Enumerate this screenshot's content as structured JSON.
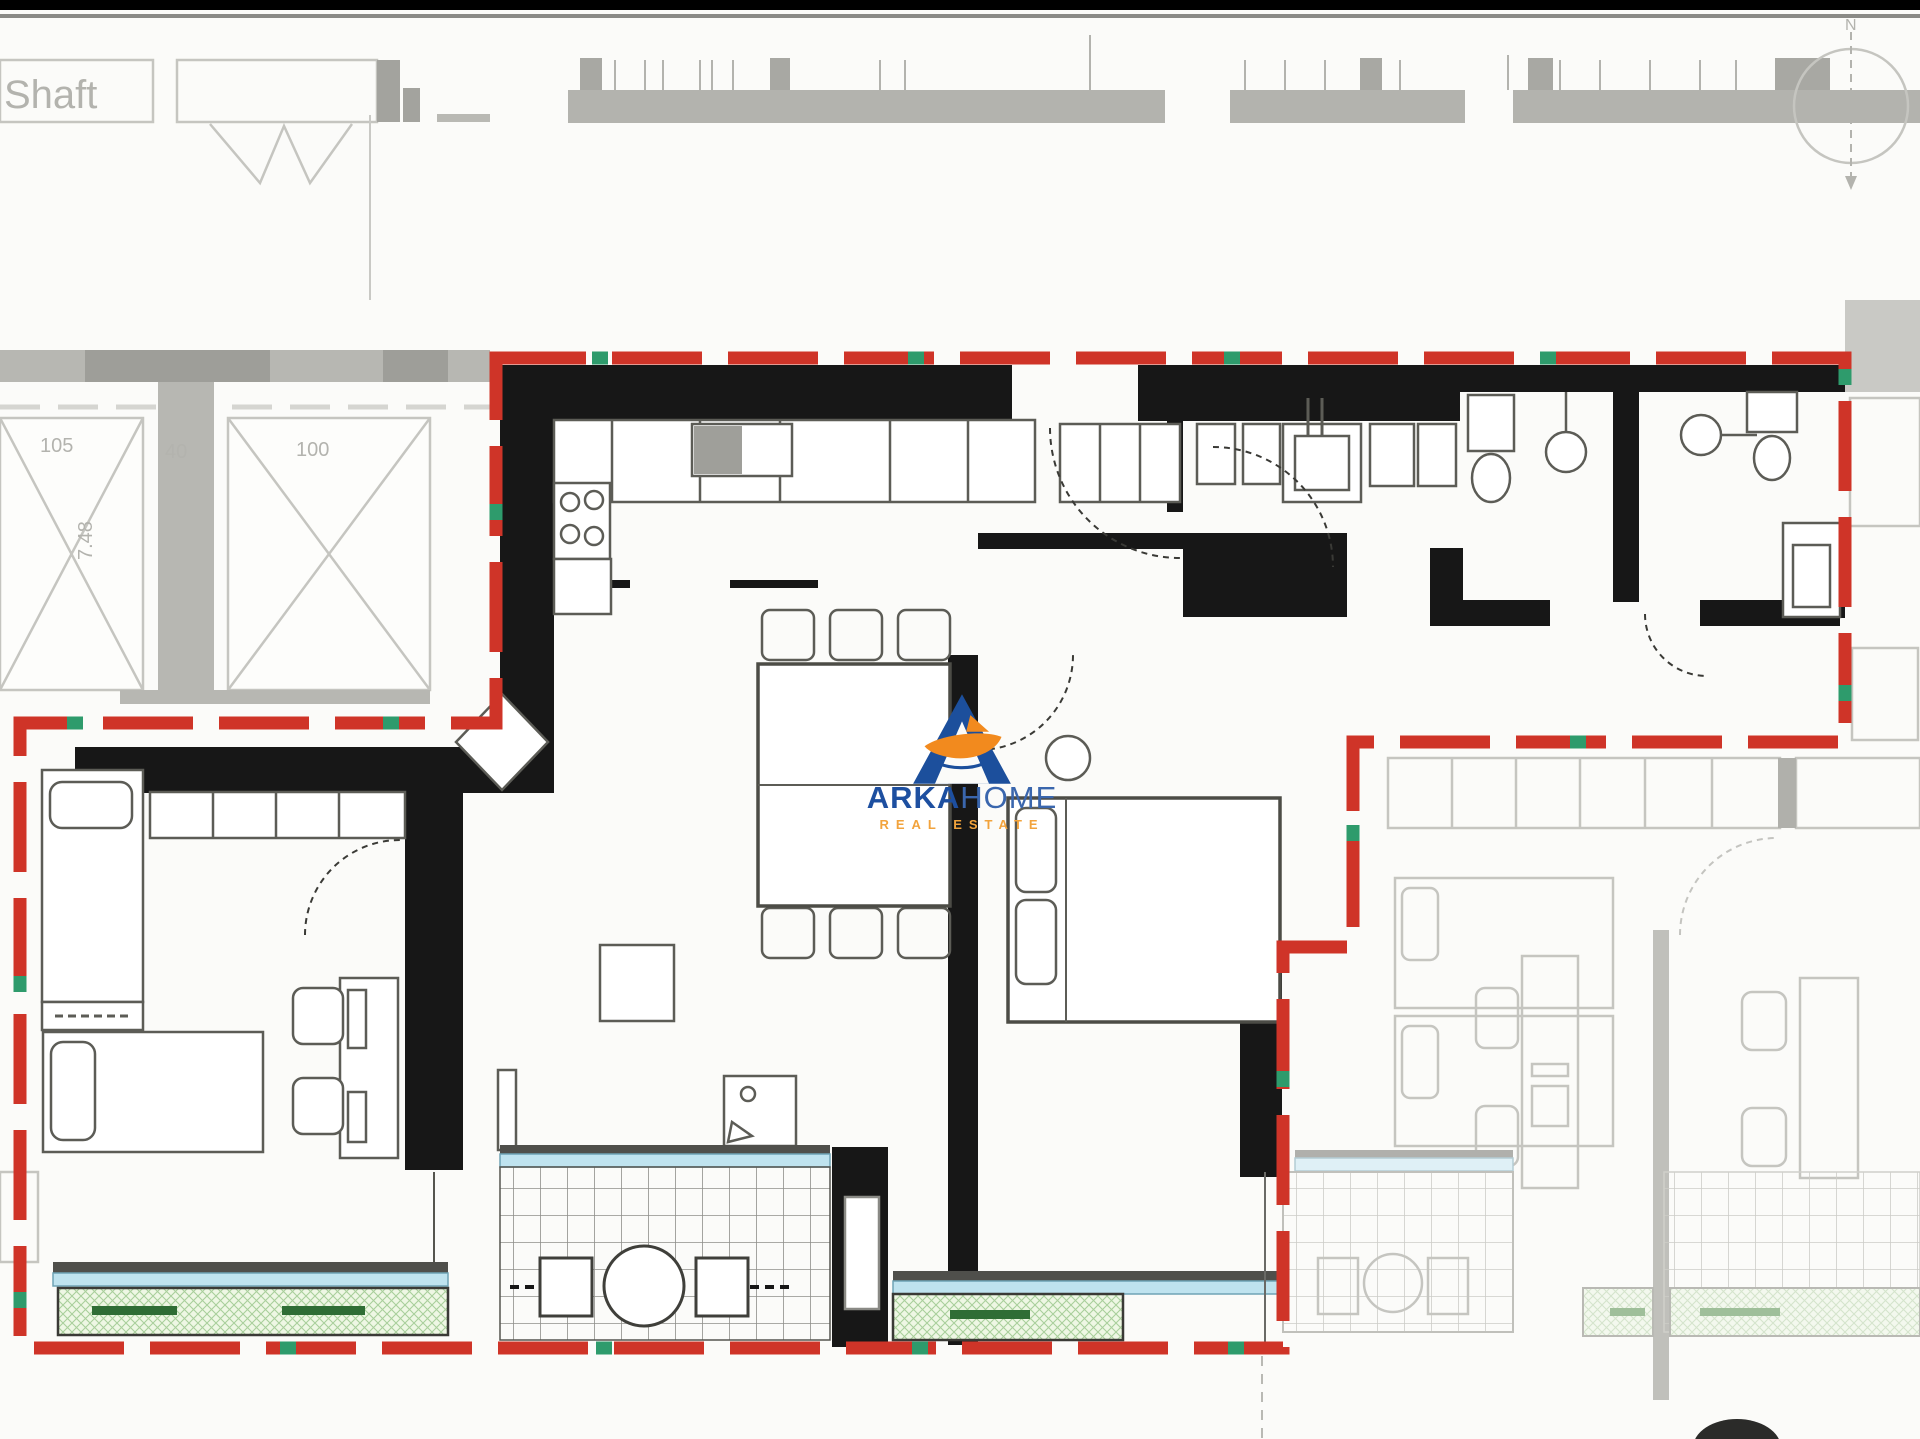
{
  "plan": {
    "labels": {
      "shaft": "Shaft",
      "compass_north": "N"
    },
    "dimensions": {
      "shaft_left_width": "105",
      "shaft_gap": "40",
      "shaft_right_width": "100",
      "shaft_depth": "7.48"
    },
    "colors": {
      "boundary_red": "#cf3428",
      "boundary_green": "#2e9b6c",
      "wall_black": "#171717",
      "window_cyan": "#bfe3ef",
      "planter_fill": "#eef7e4",
      "planter_dash": "#2f6d35",
      "faded_gray": "#c5c5c0",
      "tile_line": "#8f8f8a"
    }
  },
  "logo": {
    "brand_primary": "ARKA",
    "brand_secondary": "HOME",
    "tagline": "REAL ESTATE",
    "colors": {
      "mark_blue": "#1c4f9c",
      "mark_orange": "#f28a1e",
      "text_blue": "#1d4fa0",
      "tagline_orange": "#f2a33c"
    }
  }
}
